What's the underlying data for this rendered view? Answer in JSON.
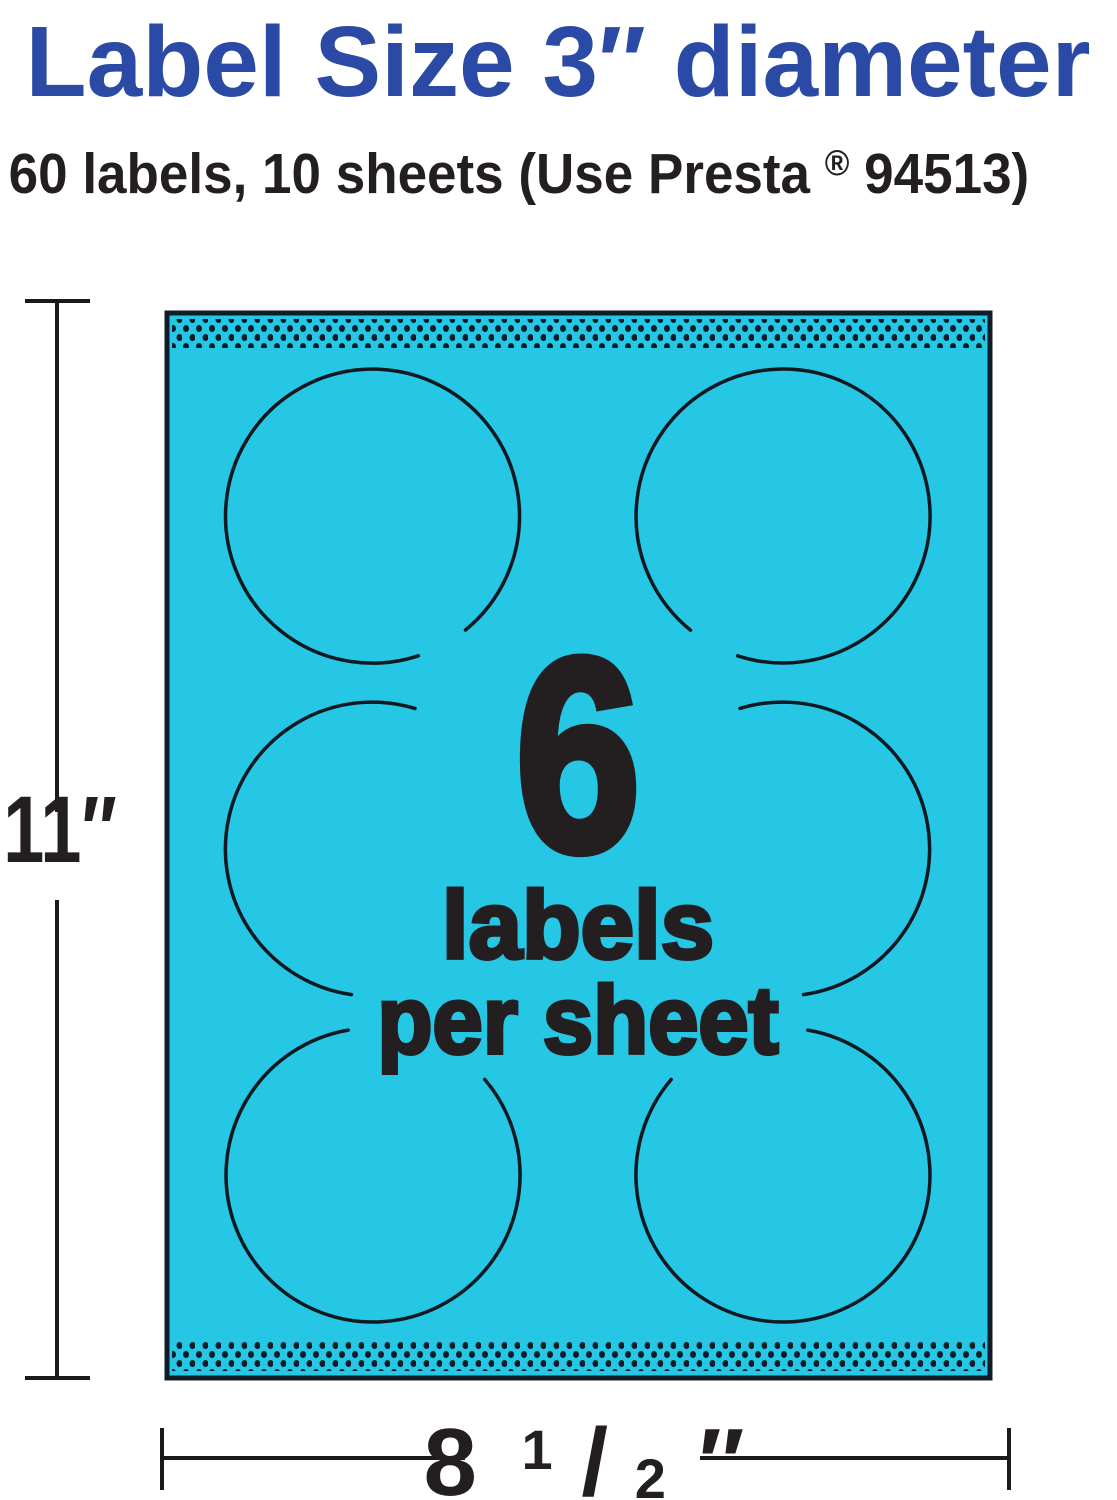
{
  "header": {
    "title": "Label Size 3″ diameter",
    "subtitle": {
      "pre": "60 labels, 10 sheets (Use Presta",
      "reg_mark": "®",
      "post": " 94513)"
    }
  },
  "sheet": {
    "labels_per_sheet_count": "6",
    "caption_line1": "labels",
    "caption_line2": "per sheet"
  },
  "dimensions": {
    "height_label": "11″",
    "width_whole": "8",
    "width_frac_numerator": "1",
    "width_frac_slash": "/",
    "width_frac_denominator": "2",
    "width_unit_mark": "″"
  },
  "colors": {
    "sheet_cyan": "#26C6E5",
    "title_blue": "#2B4AA5",
    "ink_dark": "#231F20",
    "line_dark": "#101820",
    "dot_navy": "#0E1E29",
    "ruler_dark": "#1A1A1A"
  }
}
